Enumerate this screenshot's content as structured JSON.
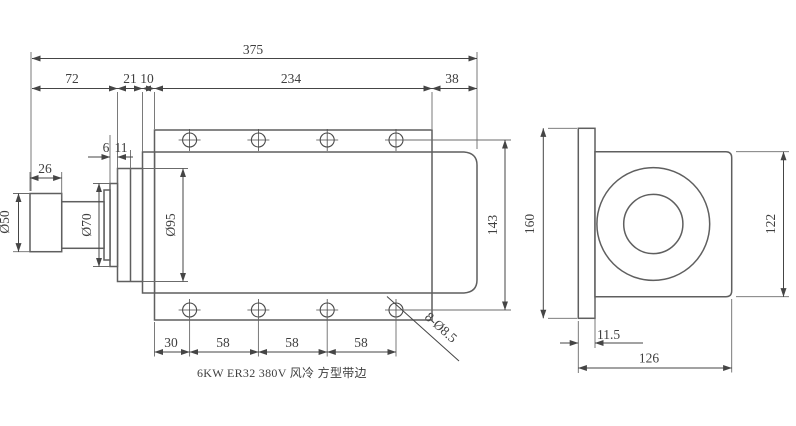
{
  "caption": "6KW ER32 380V 风冷 方型带边",
  "colors": {
    "line": "#4a4a4a",
    "background": "#ffffff"
  },
  "front_view": {
    "top_dims": {
      "total": "375",
      "seg_nut_shaft": "72",
      "seg_front_rings": "21",
      "seg_front_cap": "10",
      "seg_flange_plate": "234",
      "seg_rear_overhang": "38"
    },
    "left_dims": {
      "nut_length": "26",
      "nut_diameter": "Ø50",
      "shaft_diameter": "Ø70",
      "collar_width": "6",
      "ring_width": "11",
      "front_flange_diameter": "Ø95"
    },
    "right_dims": {
      "hole_row_spacing": "143"
    },
    "bottom_dims": {
      "edge_to_first_hole": "30",
      "hole_pitch_1": "58",
      "hole_pitch_2": "58",
      "hole_pitch_3": "58"
    },
    "hole_callout": "8-Ø8.5"
  },
  "side_view": {
    "flange_height": "160",
    "body_height": "122",
    "flange_thickness": "11.5",
    "overall_width": "126"
  }
}
